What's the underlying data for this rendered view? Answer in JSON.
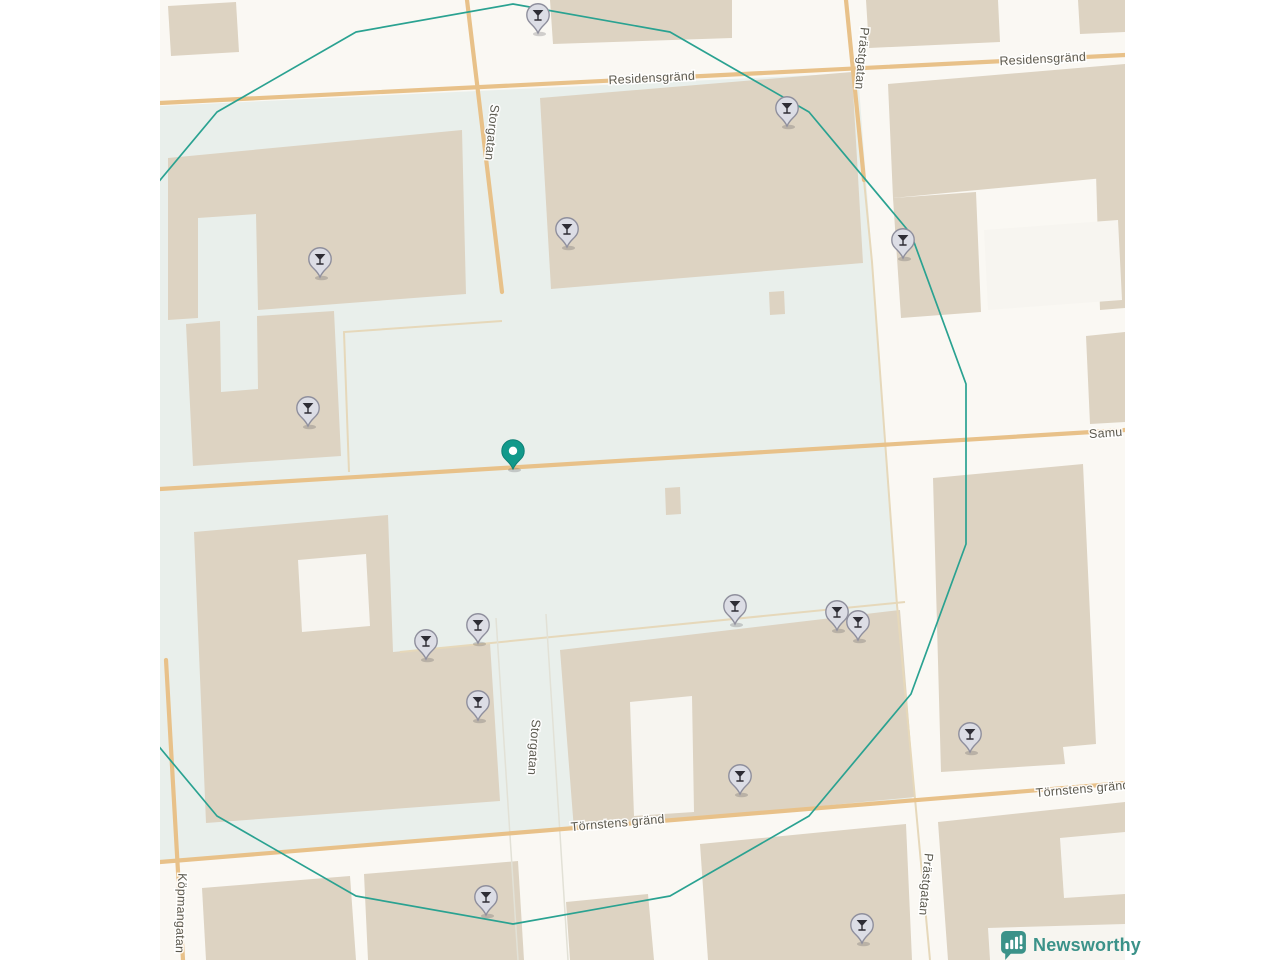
{
  "map": {
    "colors": {
      "land": "#faf8f3",
      "plaza": "#e9efeb",
      "building": "#ddd3c2",
      "courtyard": "#f7f5f0",
      "road_major": "#e8c189",
      "road_minor": "#e6d8ba",
      "circle_stroke": "#2aa291",
      "label_text": "#5c5a50",
      "pin_fill": "#dcdde5",
      "pin_stroke": "#8f8f9d",
      "pin_glyph": "#2e2d35",
      "center_pin": "#12998b"
    },
    "street_labels": [
      {
        "text": "Residensgränd",
        "x": 652,
        "y": 82,
        "rotate": -3
      },
      {
        "text": "Residensgränd",
        "x": 1043,
        "y": 63,
        "rotate": -3
      },
      {
        "text": "Storgatan",
        "x": 488,
        "y": 132,
        "rotate": 96
      },
      {
        "text": "Storgatan",
        "x": 530,
        "y": 747,
        "rotate": 94
      },
      {
        "text": "Prästgatan",
        "x": 858,
        "y": 58,
        "rotate": 95
      },
      {
        "text": "Prästgatan",
        "x": 922,
        "y": 884,
        "rotate": 95
      },
      {
        "text": "Köpmangatan",
        "x": 177,
        "y": 913,
        "rotate": 92
      },
      {
        "text": "Samu",
        "x": 1106,
        "y": 437,
        "rotate": -4
      },
      {
        "text": "Törnstens gränd",
        "x": 618,
        "y": 827,
        "rotate": -5
      },
      {
        "text": "Törnstens gränd",
        "x": 1083,
        "y": 793,
        "rotate": -5
      }
    ],
    "venue_pins": [
      [
        538,
        33
      ],
      [
        787,
        126
      ],
      [
        567,
        247
      ],
      [
        903,
        258
      ],
      [
        320,
        277
      ],
      [
        308,
        426
      ],
      [
        735,
        624
      ],
      [
        837,
        630
      ],
      [
        858,
        640
      ],
      [
        478,
        643
      ],
      [
        426,
        659
      ],
      [
        478,
        720
      ],
      [
        970,
        752
      ],
      [
        740,
        794
      ],
      [
        486,
        915
      ],
      [
        862,
        943
      ]
    ],
    "center_pin": [
      513,
      469
    ],
    "pin_glyph_name": "martini-glass"
  },
  "branding": {
    "logo_text": "Newsworthy",
    "logo_color": "#3b9289",
    "logo_icon": "bar-chart-speech-bubble"
  }
}
